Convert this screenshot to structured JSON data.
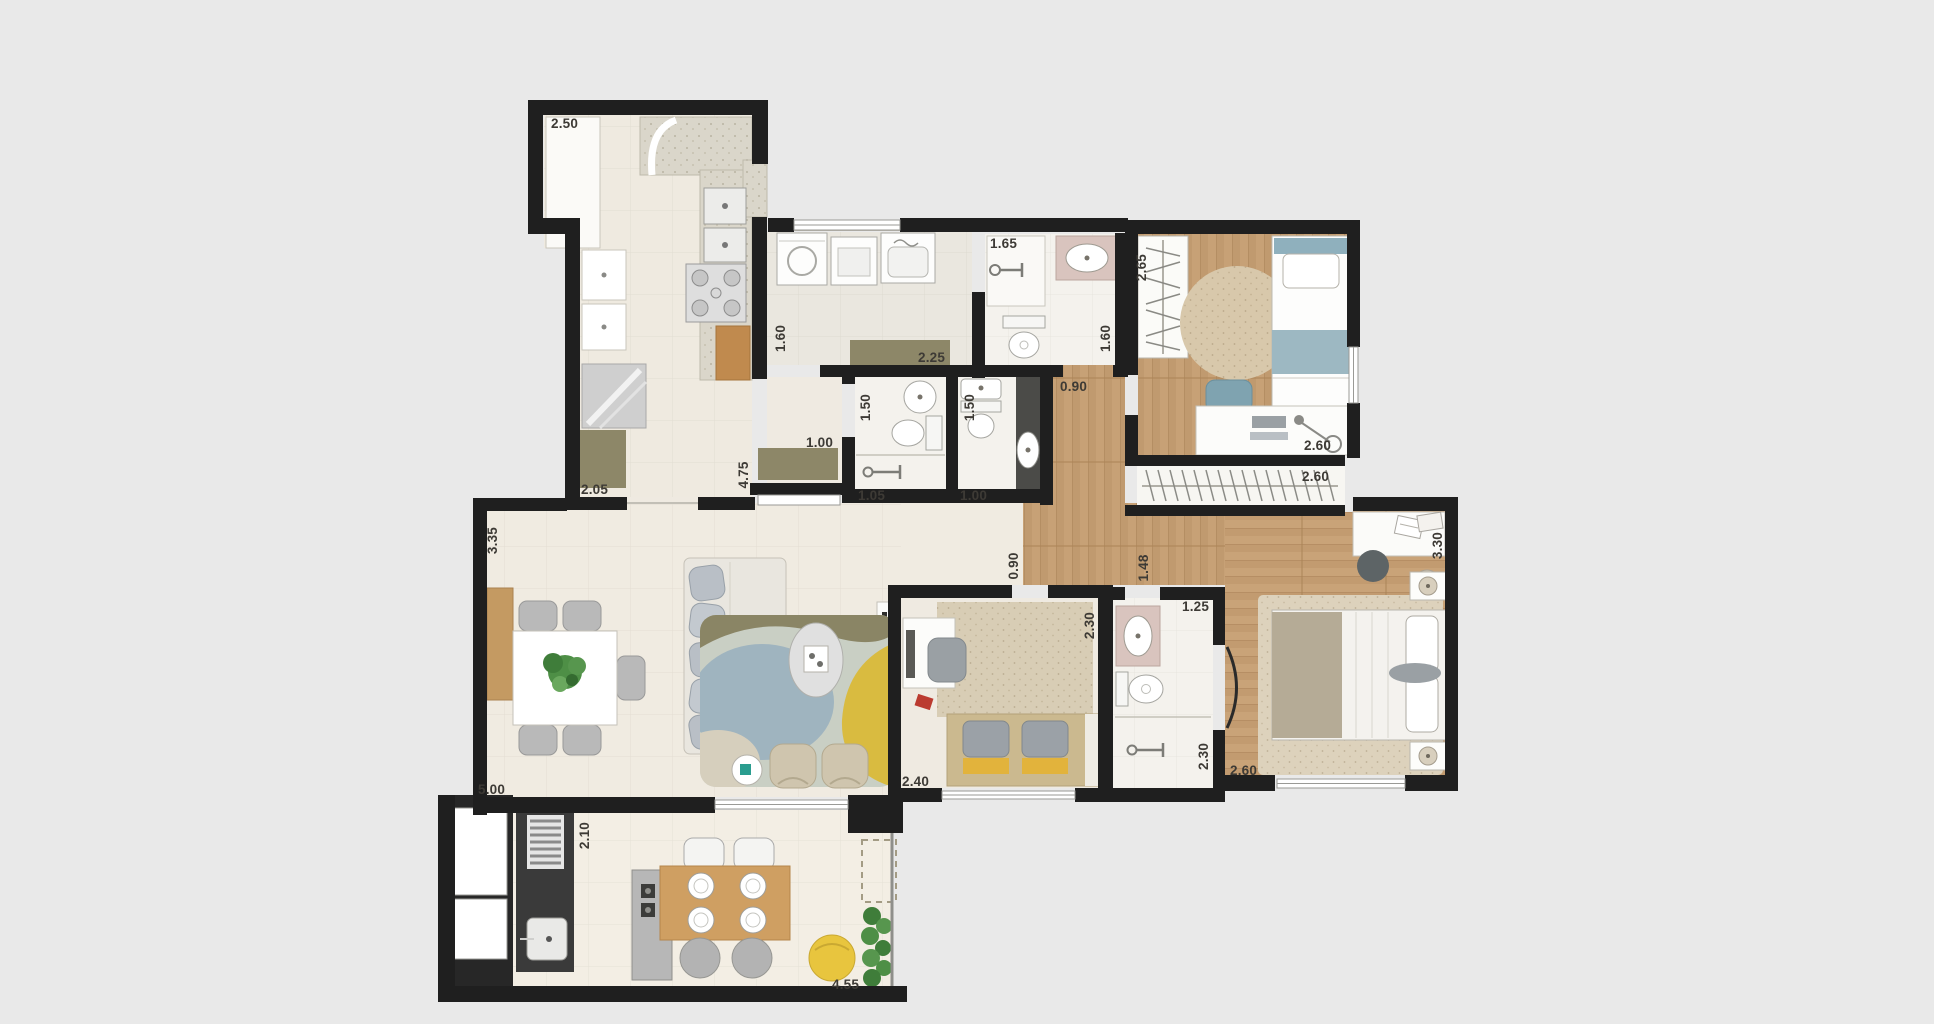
{
  "figure": {
    "kind": "apartment-floor-plan",
    "units": "m"
  },
  "colors": {
    "background": "#e9e9e9",
    "walls": "#1f1f1f",
    "tile_floor": "#f0ebe1",
    "bath_floor": "#f4f2ed",
    "wood_floor": "#c7a176",
    "rug_beige": "#d9cdb2",
    "olive_cabinet": "#8d8768",
    "accent_blue": "#8fb0bd",
    "accent_yellow": "#e2b33c",
    "vanity_pink": "#d9c4be",
    "label_text": "#3d3a35"
  },
  "dims": [
    {
      "name": "kitchen-width-top",
      "v": "2.50",
      "o": "h"
    },
    {
      "name": "suite1-bath-width",
      "v": "1.65",
      "o": "h"
    },
    {
      "name": "bedroom1-depth",
      "v": "2.65",
      "o": "v"
    },
    {
      "name": "kitchen-passage",
      "v": "1.60",
      "o": "v"
    },
    {
      "name": "laundry-width",
      "v": "2.25",
      "o": "h"
    },
    {
      "name": "lavabo-depth",
      "v": "1.50",
      "o": "v"
    },
    {
      "name": "bath2-depth",
      "v": "1.50",
      "o": "v"
    },
    {
      "name": "suite1-bath-depth",
      "v": "1.60",
      "o": "v"
    },
    {
      "name": "hall-width",
      "v": "0.90",
      "o": "h"
    },
    {
      "name": "bedroom1-width",
      "v": "2.60",
      "o": "h"
    },
    {
      "name": "closet-width",
      "v": "2.60",
      "o": "h"
    },
    {
      "name": "hall-cabinet",
      "v": "1.00",
      "o": "h"
    },
    {
      "name": "kitchen-depth",
      "v": "4.75",
      "o": "v"
    },
    {
      "name": "kitchen-width-bottom",
      "v": "2.05",
      "o": "h"
    },
    {
      "name": "lavabo-width",
      "v": "1.05",
      "o": "h"
    },
    {
      "name": "bath2-width",
      "v": "1.00",
      "o": "h"
    },
    {
      "name": "living-depth",
      "v": "3.35",
      "o": "v"
    },
    {
      "name": "corridor-passage",
      "v": "0.90",
      "o": "v"
    },
    {
      "name": "corridor-width",
      "v": "1.48",
      "o": "v"
    },
    {
      "name": "master-depth",
      "v": "3.30",
      "o": "v"
    },
    {
      "name": "office-depth",
      "v": "2.30",
      "o": "v"
    },
    {
      "name": "master-bath-width",
      "v": "1.25",
      "o": "h"
    },
    {
      "name": "living-width",
      "v": "5.00",
      "o": "h"
    },
    {
      "name": "terrace-depth",
      "v": "2.10",
      "o": "v"
    },
    {
      "name": "office-width",
      "v": "2.40",
      "o": "h"
    },
    {
      "name": "master-bath-depth",
      "v": "2.30",
      "o": "v"
    },
    {
      "name": "master-width",
      "v": "2.60",
      "o": "h"
    },
    {
      "name": "terrace-width",
      "v": "4.55",
      "o": "h"
    }
  ]
}
